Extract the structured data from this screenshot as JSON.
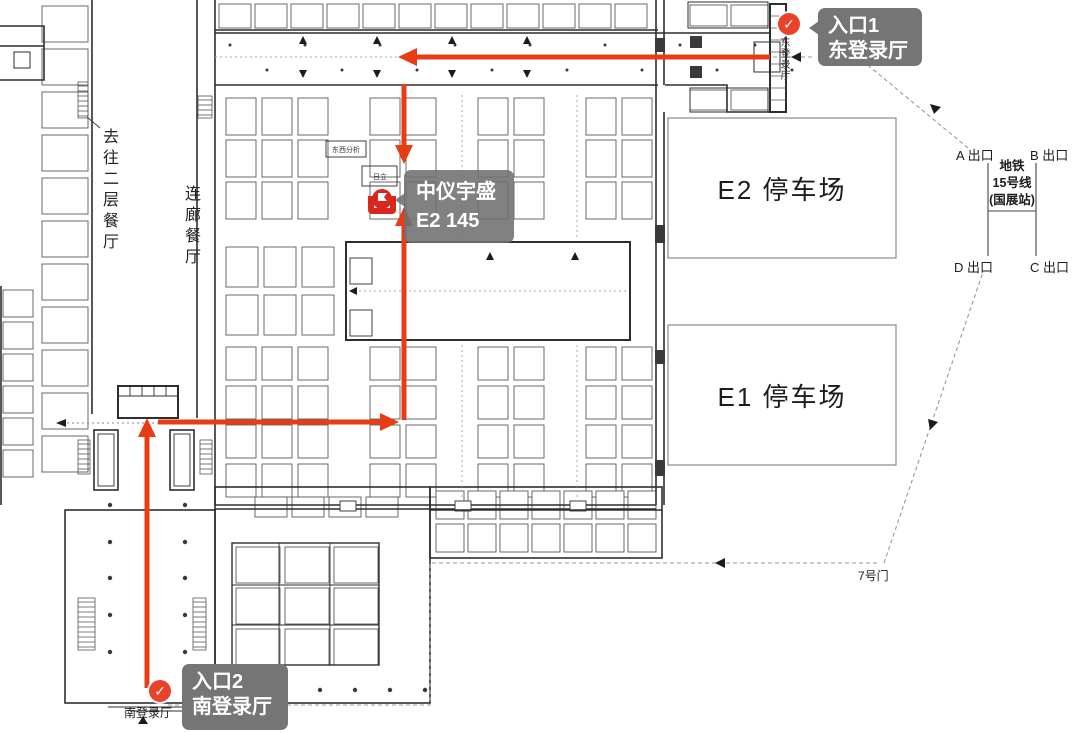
{
  "annotations": {
    "entrance1": {
      "title": "入口1",
      "subtitle": "东登录厅"
    },
    "entrance2": {
      "title": "入口2",
      "subtitle": "南登录厅"
    },
    "target_booth": {
      "company": "中仪宇盛",
      "booth_no": "E2 145"
    },
    "east_hall_vertical": "东登录厅",
    "south_hall_small": "南登录厅",
    "to_second_floor_restaurant": "去往二层餐厅",
    "corridor_restaurant": "连廊餐厅",
    "gate7": "7号门",
    "parking": {
      "e2": "E2 停车场",
      "e1": "E1 停车场"
    },
    "metro": {
      "station_lines": [
        "地铁",
        "15号线",
        "(国展站)"
      ],
      "exit_a": "A 出口",
      "exit_b": "B 出口",
      "exit_c": "C 出口",
      "exit_d": "D 出口"
    },
    "booth_labels": [
      {
        "text": "东西分析",
        "cx": 346,
        "cy": 149
      },
      {
        "text": "日立",
        "cx": 380,
        "cy": 176
      }
    ]
  },
  "icons": {
    "entrance_check": "✓",
    "booth_marker": "booth-location-logo"
  },
  "colors": {
    "route_red": "#e73c14",
    "marker_red": "#e8432a",
    "bubble_gray": "#757575",
    "booth_bubble_gray": "rgba(112,112,112,0.88)",
    "wall": "#2e2e2e",
    "booth_line": "#5a5a5a",
    "parking_border": "#8a8a8a",
    "dashed_route": "#999999"
  }
}
